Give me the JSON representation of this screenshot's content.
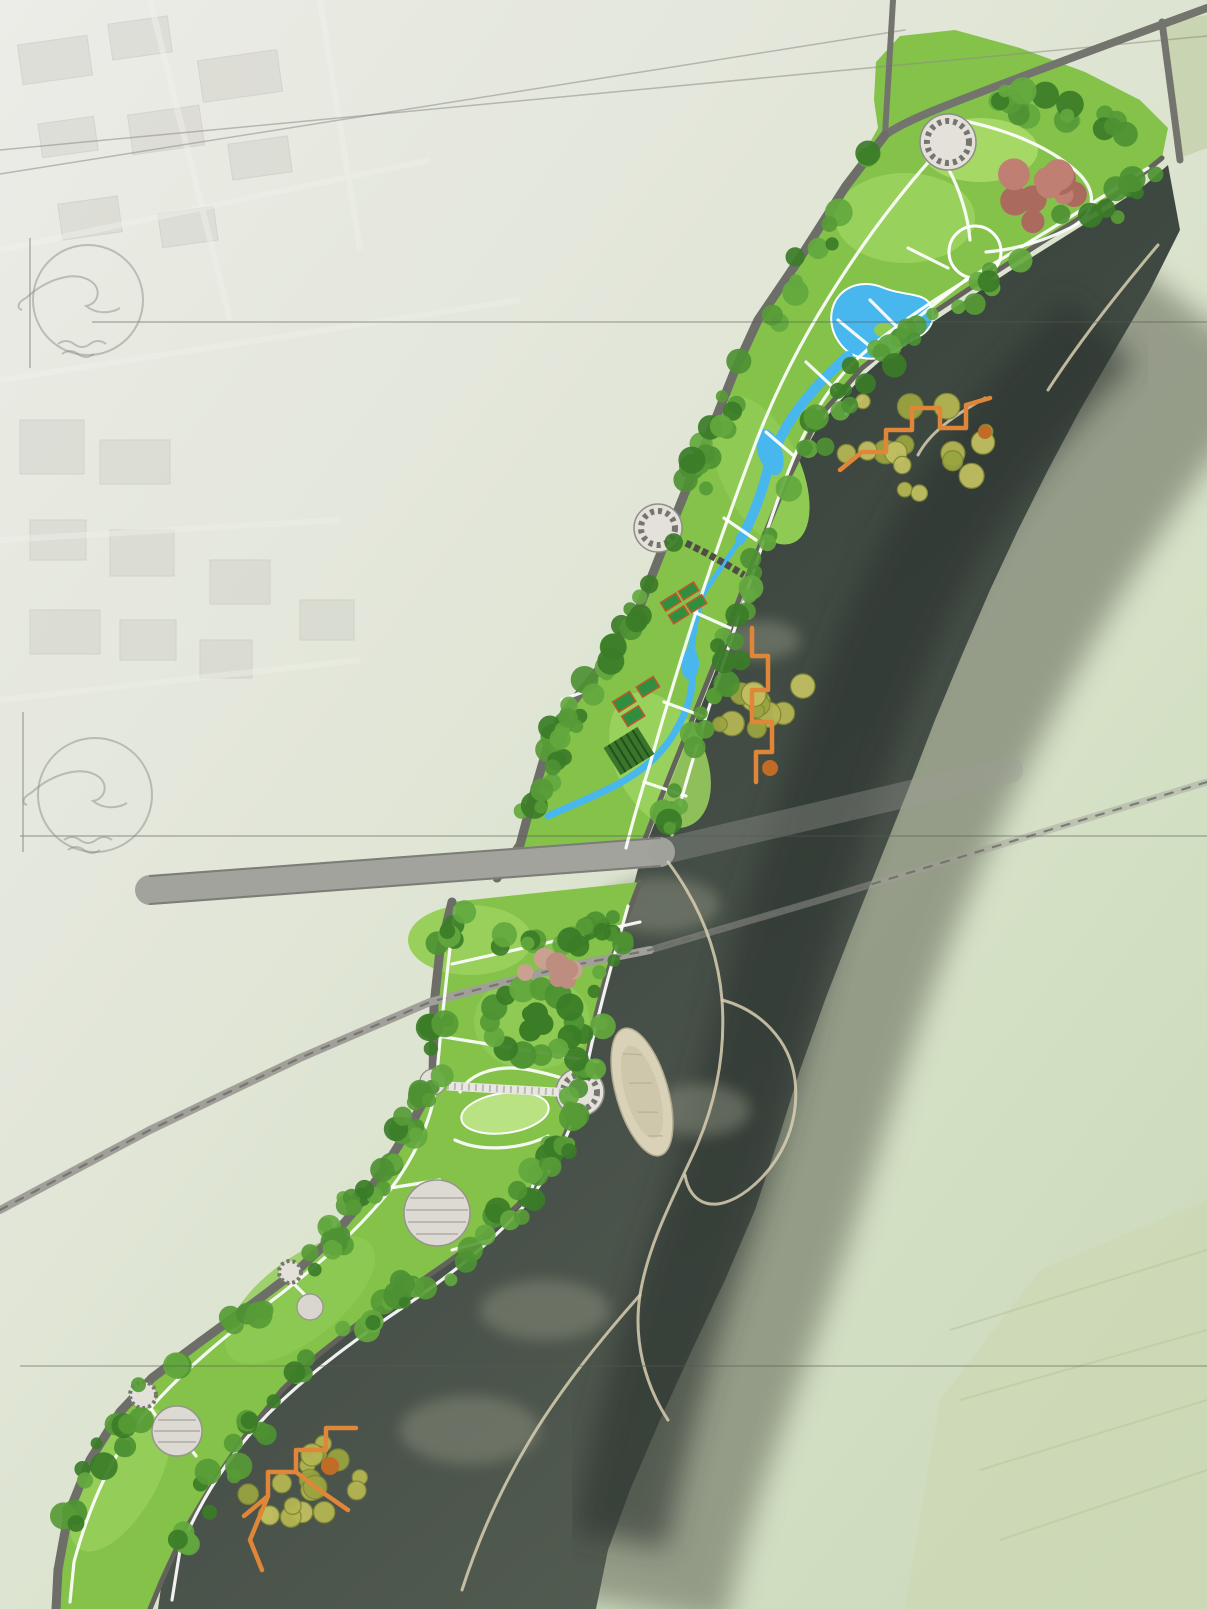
{
  "map": {
    "labels": {
      "road": "高铁大道",
      "railway": "郑西高铁"
    },
    "watermark": {
      "cn": "洛阳古建园林设计院有限公司",
      "en": "LUOYANGGUJIANYUANLINSHEJIYUANYOUXIANGONGSI"
    },
    "palette": {
      "marker_red": "#e8161c",
      "marker_edge": "#a50d12",
      "park_green": "#84c24a",
      "water_blue": "#47b7ee",
      "river_dark": "#3a443e",
      "boardwalk_orange": "#df8638",
      "road_gray": "#6e6e68"
    },
    "markers": [
      {
        "n": "1",
        "x": 940,
        "y": 167
      },
      {
        "n": "10",
        "x": 995,
        "y": 210
      },
      {
        "n": "9",
        "x": 975,
        "y": 245
      },
      {
        "n": "2",
        "x": 1039,
        "y": 262
      },
      {
        "n": "9",
        "x": 795,
        "y": 340
      },
      {
        "n": "3",
        "x": 762,
        "y": 357
      },
      {
        "n": "5",
        "x": 848,
        "y": 357
      },
      {
        "n": "4",
        "x": 879,
        "y": 351
      },
      {
        "n": "8",
        "x": 748,
        "y": 405
      },
      {
        "n": "6",
        "x": 834,
        "y": 398
      },
      {
        "n": "15",
        "x": 785,
        "y": 420
      },
      {
        "n": "2",
        "x": 846,
        "y": 414
      },
      {
        "n": "13",
        "x": 880,
        "y": 420
      },
      {
        "n": "11",
        "x": 935,
        "y": 420
      },
      {
        "n": "13",
        "x": 986,
        "y": 405
      },
      {
        "n": "23",
        "x": 725,
        "y": 438
      },
      {
        "n": "22",
        "x": 766,
        "y": 483
      },
      {
        "n": "10",
        "x": 700,
        "y": 518
      },
      {
        "n": "8",
        "x": 731,
        "y": 518
      },
      {
        "n": "1",
        "x": 659,
        "y": 535
      },
      {
        "n": "1",
        "x": 740,
        "y": 585
      },
      {
        "n": "16",
        "x": 678,
        "y": 590
      },
      {
        "n": "8",
        "x": 700,
        "y": 620
      },
      {
        "n": "9",
        "x": 616,
        "y": 629
      },
      {
        "n": "19",
        "x": 649,
        "y": 642
      },
      {
        "n": "18",
        "x": 613,
        "y": 664
      },
      {
        "n": "3",
        "x": 562,
        "y": 700
      },
      {
        "n": "17",
        "x": 626,
        "y": 717
      },
      {
        "n": "8",
        "x": 596,
        "y": 731
      },
      {
        "n": "23",
        "x": 653,
        "y": 730
      },
      {
        "n": "21",
        "x": 565,
        "y": 754
      },
      {
        "n": "20",
        "x": 612,
        "y": 765
      },
      {
        "n": "11",
        "x": 754,
        "y": 695
      },
      {
        "n": "12",
        "x": 730,
        "y": 729
      },
      {
        "n": "23",
        "x": 529,
        "y": 823
      },
      {
        "n": "1",
        "x": 433,
        "y": 1084
      },
      {
        "n": "1",
        "x": 577,
        "y": 1091
      },
      {
        "n": "7",
        "x": 498,
        "y": 1106
      },
      {
        "n": "14",
        "x": 658,
        "y": 1073
      },
      {
        "n": "3",
        "x": 383,
        "y": 1171
      },
      {
        "n": "9",
        "x": 439,
        "y": 1181
      },
      {
        "n": "23",
        "x": 538,
        "y": 1172
      },
      {
        "n": "10",
        "x": 421,
        "y": 1209
      },
      {
        "n": "2",
        "x": 450,
        "y": 1251
      },
      {
        "n": "3",
        "x": 288,
        "y": 1276
      },
      {
        "n": "10",
        "x": 311,
        "y": 1303
      },
      {
        "n": "3",
        "x": 133,
        "y": 1393
      },
      {
        "n": "10",
        "x": 165,
        "y": 1432
      },
      {
        "n": "2",
        "x": 193,
        "y": 1459
      },
      {
        "n": "13",
        "x": 287,
        "y": 1459
      },
      {
        "n": "11",
        "x": 324,
        "y": 1441
      }
    ]
  }
}
